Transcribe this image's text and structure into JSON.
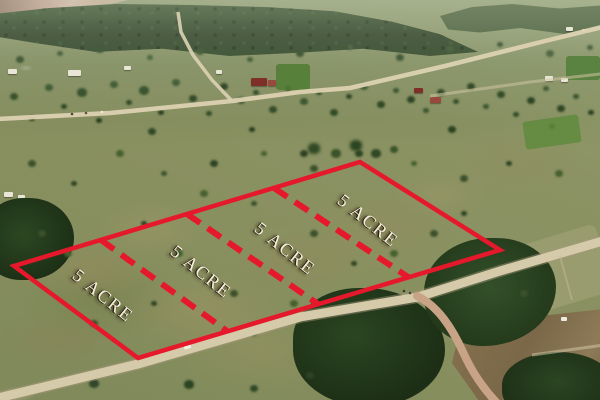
{
  "scene": {
    "plots": [
      {
        "label": "5 ACRE"
      },
      {
        "label": "5 ACRE"
      },
      {
        "label": "5 ACRE"
      },
      {
        "label": "5 ACRE"
      }
    ],
    "annotation_colors": {
      "boundary": "#e6182b",
      "label_text": "#f4eedb"
    }
  }
}
